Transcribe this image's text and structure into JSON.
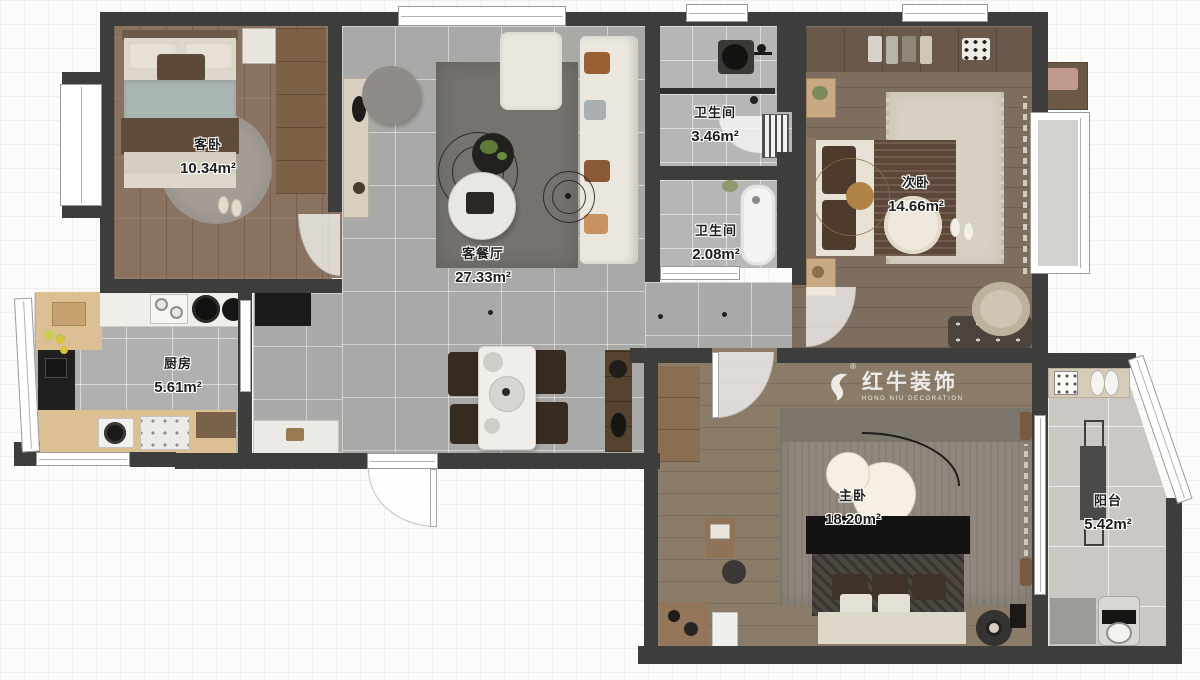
{
  "watermark": {
    "brand_cn": "红牛装饰",
    "brand_en": "HONG NIU DECORATION",
    "registered": "®"
  },
  "rooms": [
    {
      "id": "guest-bedroom",
      "name": "客卧",
      "area": "10.34m²"
    },
    {
      "id": "living-dining",
      "name": "客餐厅",
      "area": "27.33m²"
    },
    {
      "id": "bathroom-main",
      "name": "卫生间",
      "area": "3.46m²"
    },
    {
      "id": "bathroom-small",
      "name": "卫生间",
      "area": "2.08m²"
    },
    {
      "id": "second-bedroom",
      "name": "次卧",
      "area": "14.66m²"
    },
    {
      "id": "kitchen",
      "name": "厨房",
      "area": "5.61m²"
    },
    {
      "id": "master-bedroom",
      "name": "主卧",
      "area": "18.20m²"
    },
    {
      "id": "balcony",
      "name": "阳台",
      "area": "5.42m²"
    }
  ],
  "colors": {
    "wall": "#3d3d3b",
    "tile": "#a9a9a7",
    "tile_bath": "#b6b6b4",
    "tile_kitchen": "#b0b0ae",
    "tile_balcony": "#cbc8c3",
    "wood_guest": "#8a7260",
    "wood_bed2": "#7d6e5f",
    "wood_master": "#8b7c6a",
    "rug_living": "#76736e",
    "rug_bed2": "#d8d1c3",
    "rug_master": "#90887d",
    "sofa": "#ebe7df",
    "chair_dark": "#372a21",
    "counter_wood": "#dcbf93",
    "label_ink": "#1f1e1c"
  }
}
